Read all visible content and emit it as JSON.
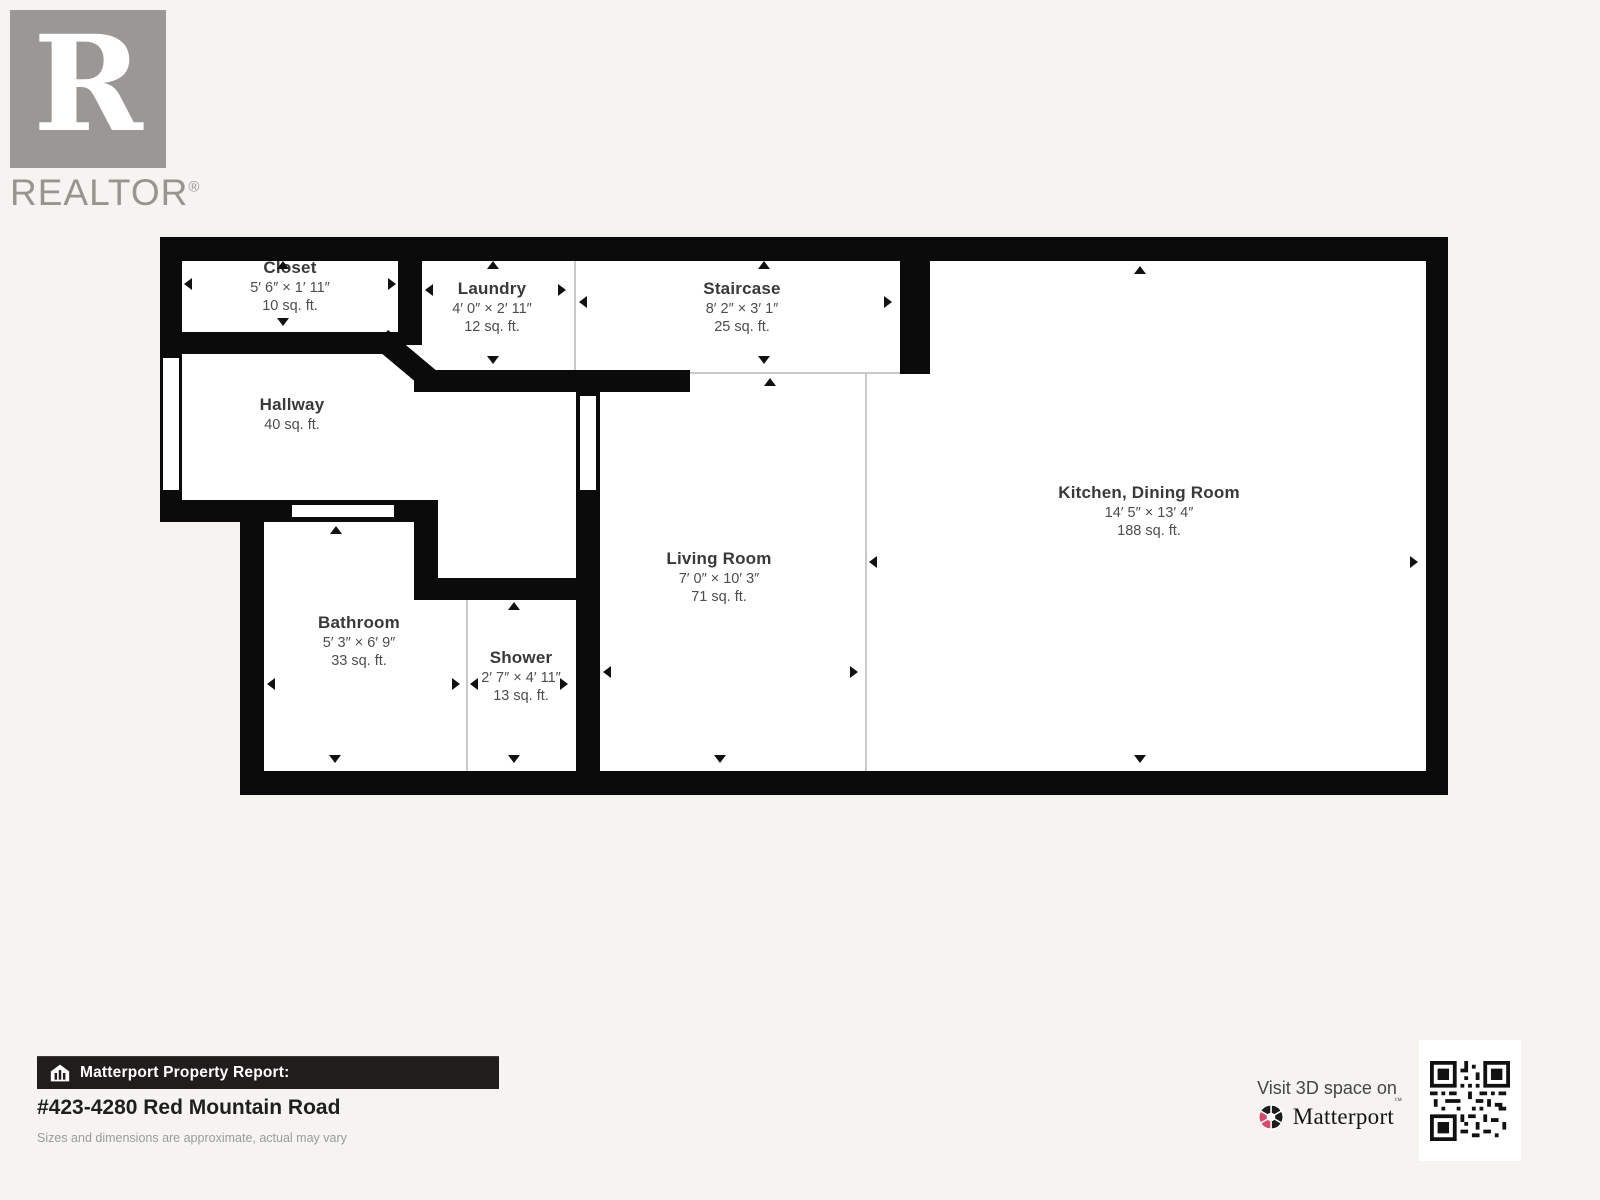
{
  "branding": {
    "logo_letter": "R",
    "wordmark": "REALTOR",
    "registered_mark": "®"
  },
  "floorplan": {
    "rooms": [
      {
        "name": "Closet",
        "dimensions": "5′ 6″ × 1′ 11″",
        "area": "10 sq. ft."
      },
      {
        "name": "Laundry",
        "dimensions": "4′ 0″ × 2′ 11″",
        "area": "12 sq. ft."
      },
      {
        "name": "Staircase",
        "dimensions": "8′ 2″ × 3′ 1″",
        "area": "25 sq. ft."
      },
      {
        "name": "Hallway",
        "dimensions": "",
        "area": "40 sq. ft."
      },
      {
        "name": "Kitchen, Dining Room",
        "dimensions": "14′ 5″ × 13′ 4″",
        "area": "188 sq. ft."
      },
      {
        "name": "Living Room",
        "dimensions": "7′ 0″ × 10′ 3″",
        "area": "71 sq. ft."
      },
      {
        "name": "Bathroom",
        "dimensions": "5′ 3″ × 6′ 9″",
        "area": "33 sq. ft."
      },
      {
        "name": "Shower",
        "dimensions": "2′ 7″ × 4′ 11″",
        "area": "13 sq. ft."
      }
    ]
  },
  "footer": {
    "report_label": "Matterport Property Report:",
    "address": "#423-4280 Red Mountain Road",
    "disclaimer": "Sizes and dimensions are approximate, actual may vary",
    "visit_text": "Visit 3D space on",
    "matterport_wordmark": "Matterport",
    "trademark_mark": "™"
  },
  "colors": {
    "wall": "#0b0b0b",
    "background": "#f5f4f1",
    "matterport_pink": "#d9476b",
    "realtor_gray": "#9b9795"
  }
}
